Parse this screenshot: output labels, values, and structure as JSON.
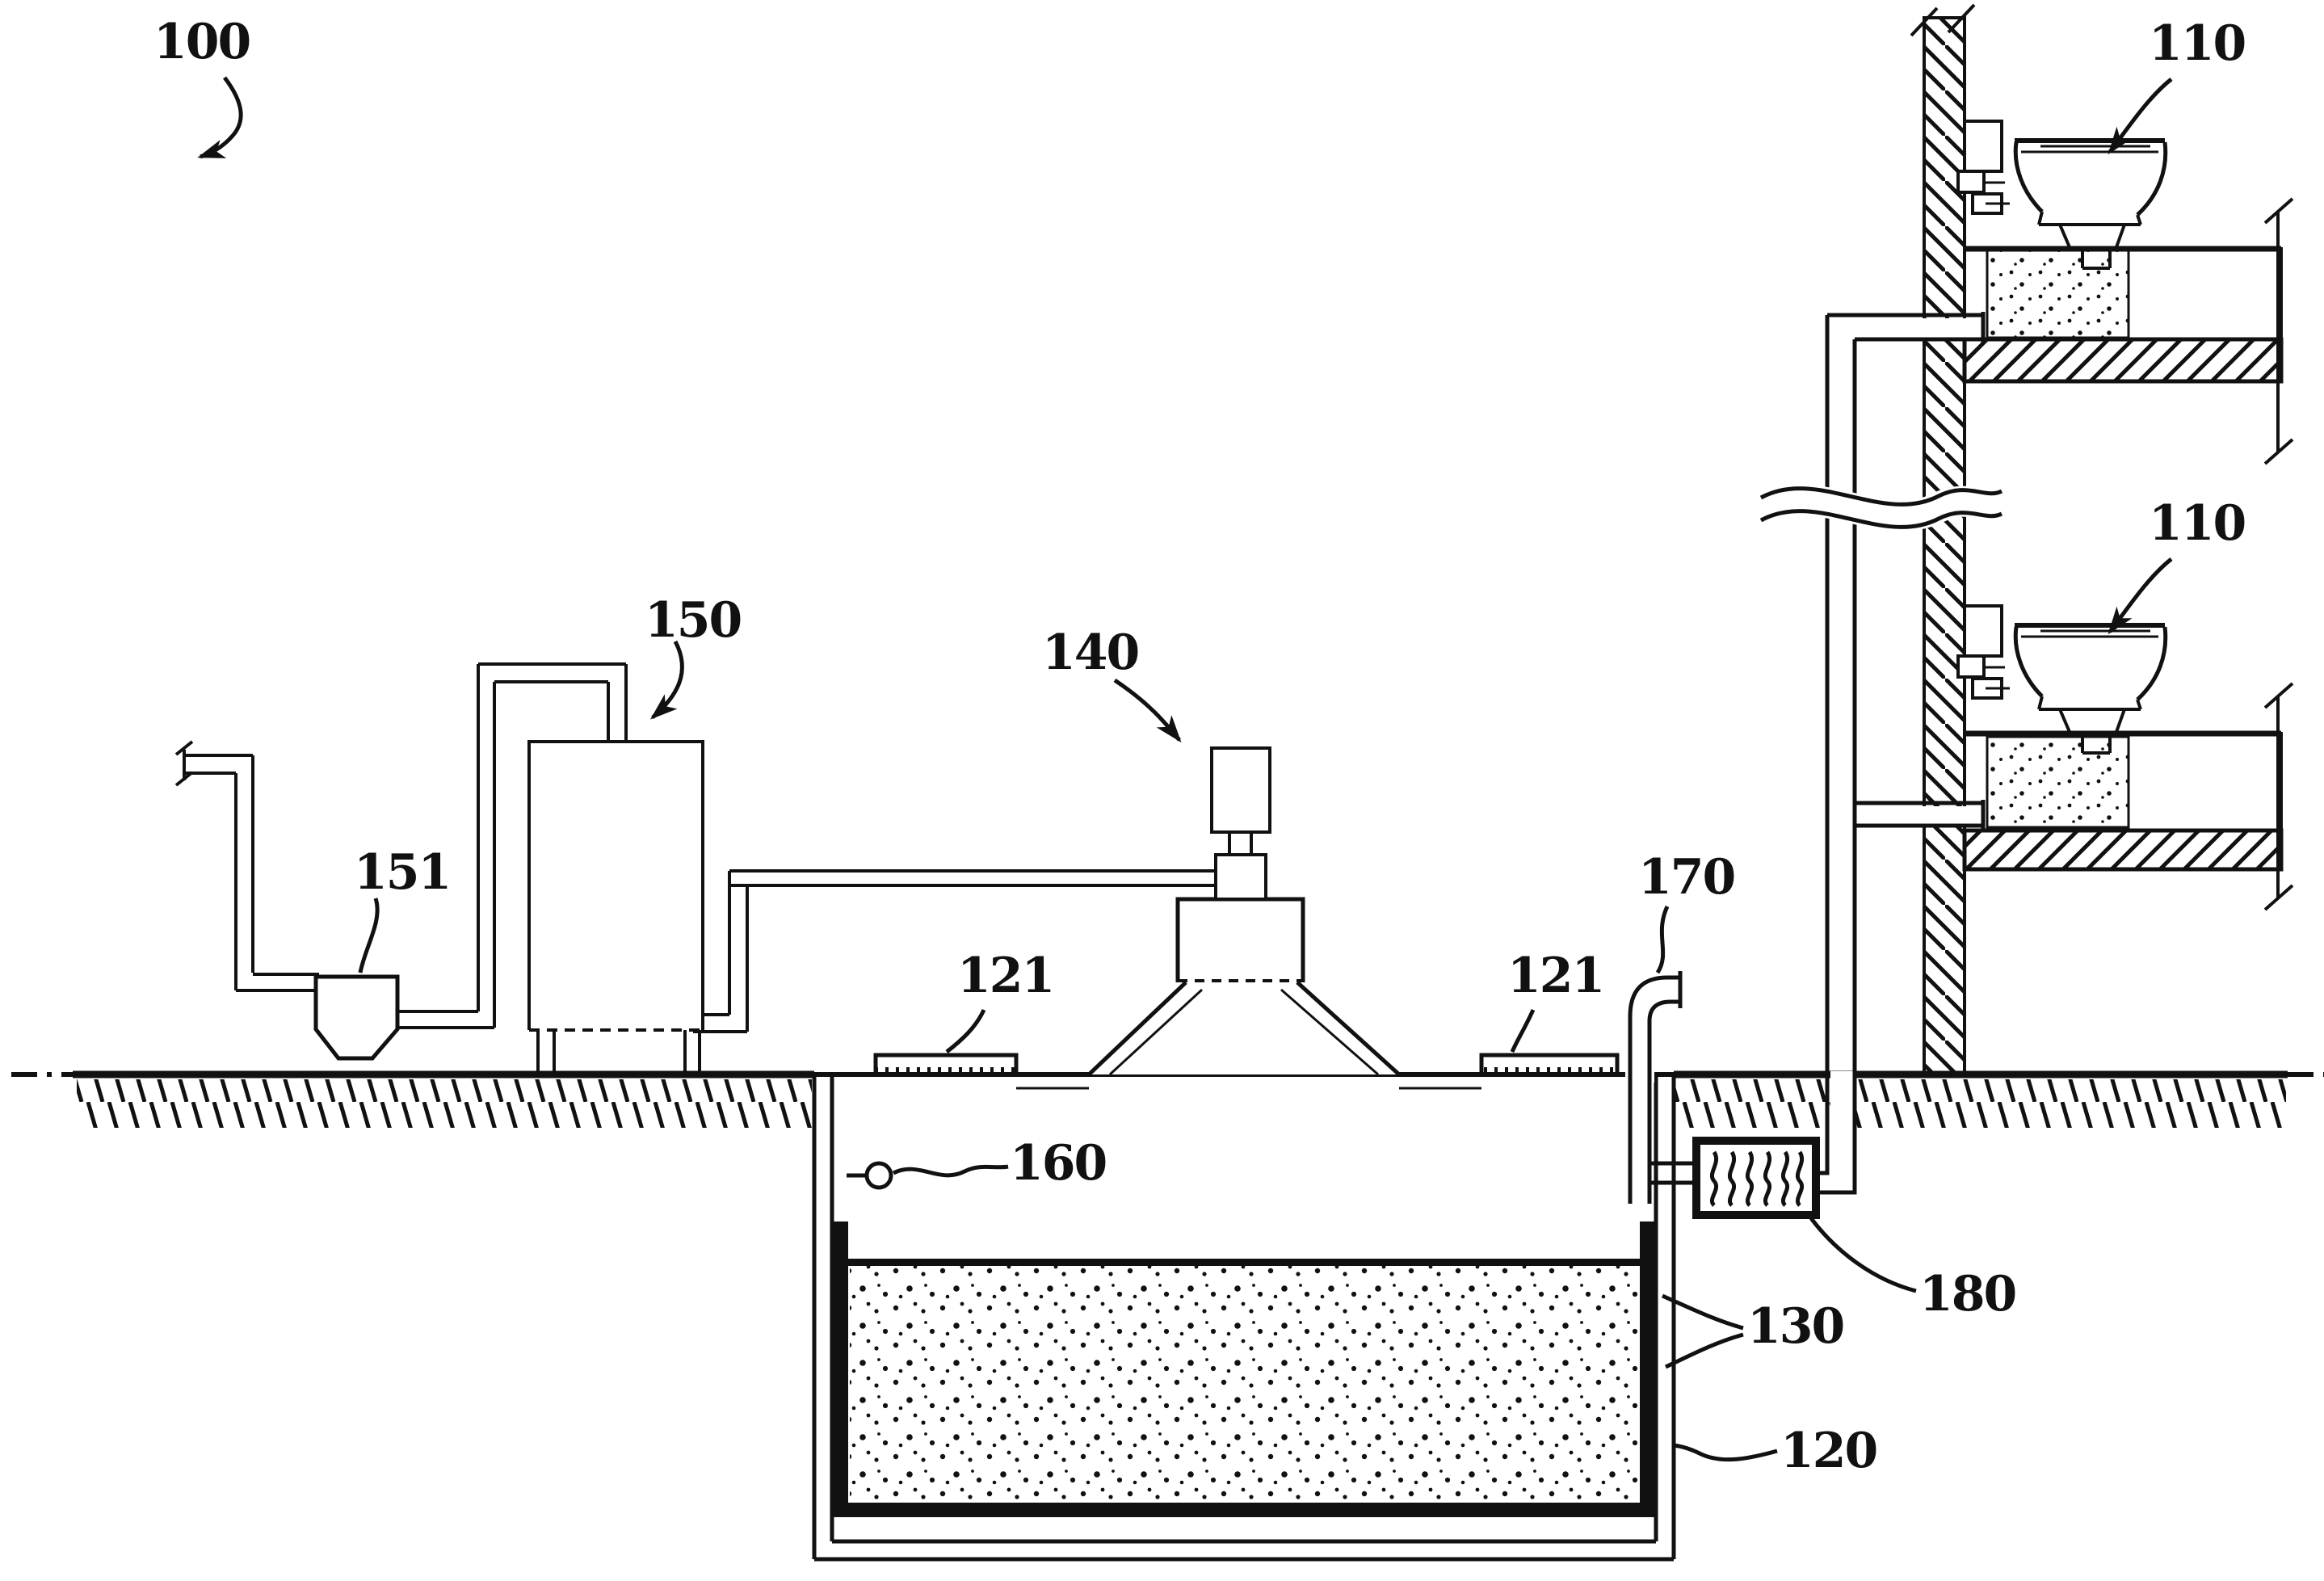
{
  "figure": {
    "kind": "patent sectional diagram",
    "description": "Sewage treatment system with building toilets, buried aggregate tank, agitator motor, hopper feed unit, vent and trap"
  },
  "labels": {
    "system": "100",
    "toilet_upper": "110",
    "toilet_lower": "110",
    "tank": "120",
    "access_port_left": "121",
    "access_port_right": "121",
    "liner": "130",
    "agitator_motor": "140",
    "treatment_unit": "150",
    "hopper": "151",
    "sensor": "160",
    "vent_pipe": "170",
    "trap_device": "180"
  }
}
